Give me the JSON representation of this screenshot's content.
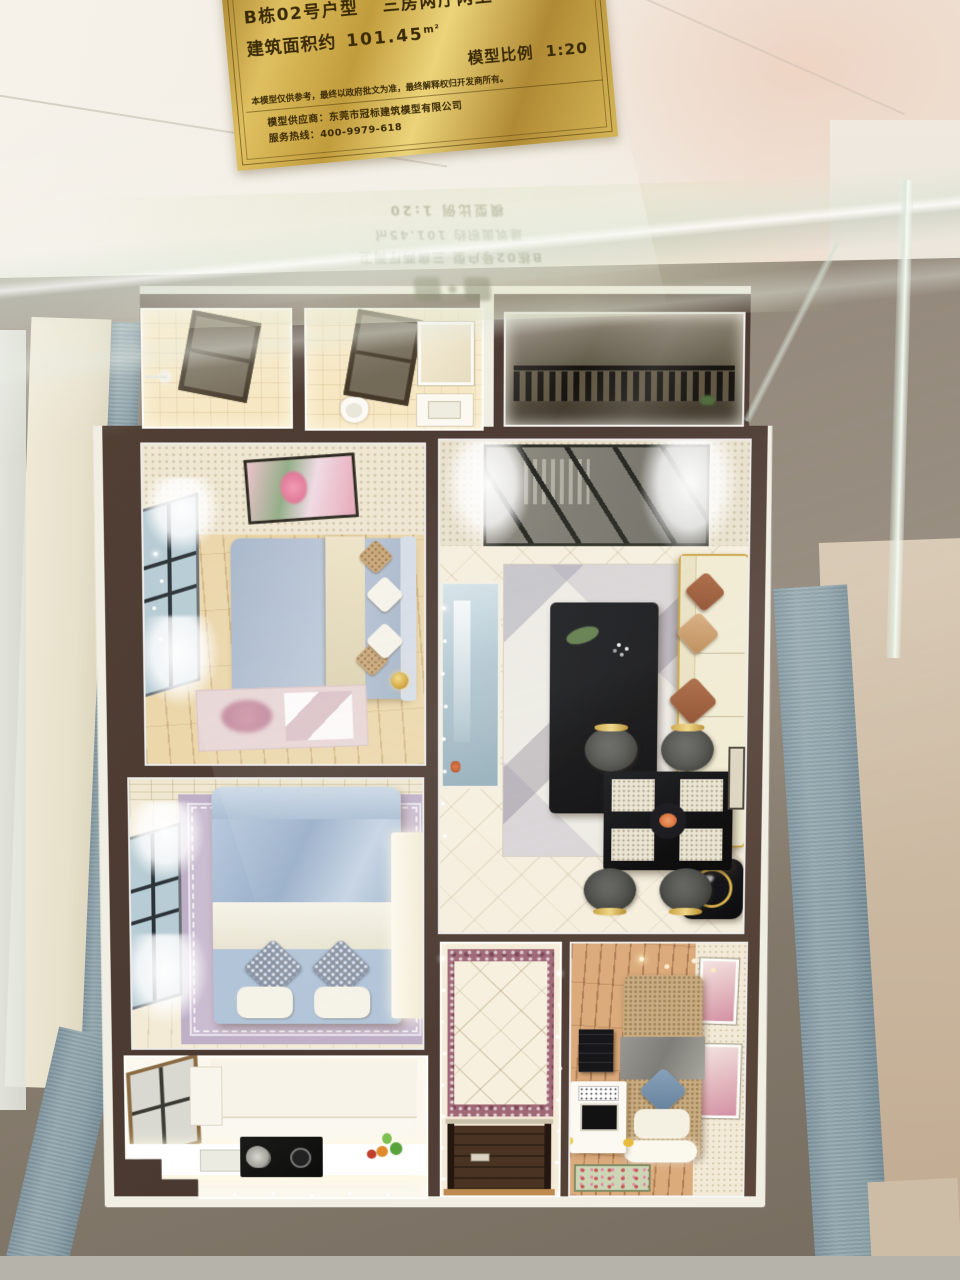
{
  "placard": {
    "unit_name": "B栋02号户型",
    "layout_type": "三房两厅两卫",
    "area_label": "建筑面积约",
    "area_value": "101.45",
    "area_unit": "m²",
    "scale_label": "模型比例",
    "scale_value": "1:20",
    "disclaimer": "本模型仅供参考，最终以政府批文为准，最终解释权归开发商所有。",
    "supplier_line": "模型供应商：东莞市冠标建筑模型有限公司",
    "hotline_line": "服务热线：400-9979-618"
  },
  "glass_reflection": {
    "line_unit": "B栋02号户型 三房两厅两卫",
    "line_area": "建筑面积约 101.45㎡",
    "line_scale": "模型比例 1:20"
  },
  "palette": {
    "placard_gold": "#d7b44c",
    "placard_text": "#3a2a06",
    "model_wall_brown": "#4e3c33",
    "model_rim_white": "#f1eee3",
    "display_base_gray": "#8d8274",
    "case_strip_blue": "#8fa3ab",
    "floor_cream": "#f6efde",
    "bed_satin_blue": "#b5c4d6",
    "sofa_cream": "#f1ebd2",
    "accent_gold": "#c9a23c",
    "wood_floor_light": "#ecd7ab",
    "wood_floor_warm": "#dcab7c",
    "marble_border": "#a06876"
  }
}
